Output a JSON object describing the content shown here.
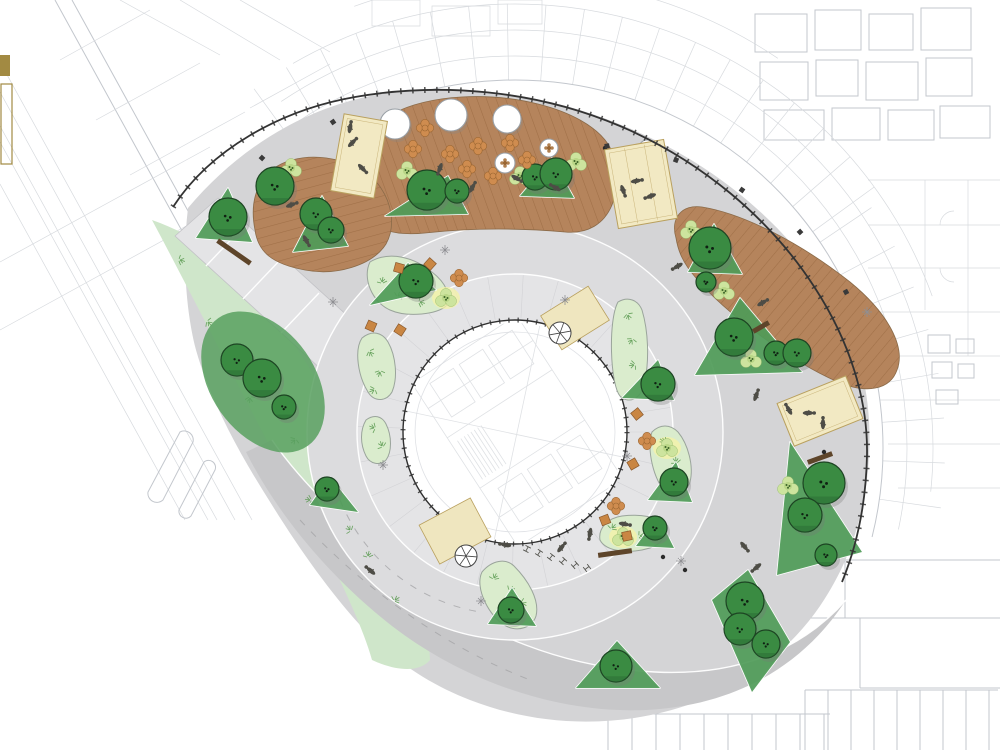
{
  "title": "Circular plaza landscape site plan around tower footprint",
  "colors": {
    "cad_light": "#d7dade",
    "cad_mid": "#c3c7cd",
    "plaza": "#d4d4d6",
    "plaza_dark": "#c7c7c9",
    "road": "#dcdcde",
    "inner_ring": "#e4e4e6",
    "walkway": "#e4e4e6",
    "curb": "#ffffff",
    "lawn": "#cfe6ca",
    "bed": "#daeccd",
    "bed_line": "#9aa49b",
    "under_green": "#4f9b58",
    "blob_green": "#58a05f",
    "tree": "#3a8b42",
    "tree_dark": "#2a6b33",
    "tree_line": "#1d4423",
    "shrub": "#cde49e",
    "shrub_mid": "#b9d687",
    "shrub_dot": "#3c6428",
    "deck": "#b5845c",
    "plank": "#9f6f47",
    "platform": "#f2e9c3",
    "platform_line": "#b9a05e",
    "mat": "#efe6bf",
    "gold": "#a28a42",
    "flower": "#cf8c4f",
    "flower_line": "#9a6632",
    "bench": "#5e452a",
    "people": "#4e4d46",
    "arc": "#333333",
    "glow": "#f6f3a6",
    "canopy_line": "#9aa0a6",
    "metal": "#8f8f93"
  },
  "legend": {
    "swatch_color": "#a28a42"
  },
  "plan": {
    "trees": [
      [
        228,
        217,
        19
      ],
      [
        275,
        186,
        19
      ],
      [
        316,
        214,
        16
      ],
      [
        331,
        230,
        13
      ],
      [
        427,
        190,
        20
      ],
      [
        457,
        191,
        12
      ],
      [
        535,
        177,
        13
      ],
      [
        556,
        174,
        16
      ],
      [
        710,
        248,
        21
      ],
      [
        706,
        282,
        10
      ],
      [
        734,
        337,
        19
      ],
      [
        776,
        353,
        12
      ],
      [
        797,
        353,
        14
      ],
      [
        416,
        281,
        17
      ],
      [
        658,
        384,
        17
      ],
      [
        674,
        482,
        14
      ],
      [
        655,
        528,
        12
      ],
      [
        237,
        360,
        16
      ],
      [
        262,
        378,
        19
      ],
      [
        284,
        407,
        12
      ],
      [
        327,
        489,
        12
      ],
      [
        511,
        610,
        13
      ],
      [
        616,
        666,
        16
      ],
      [
        824,
        483,
        21
      ],
      [
        805,
        515,
        17
      ],
      [
        826,
        555,
        11
      ],
      [
        745,
        601,
        19
      ],
      [
        740,
        629,
        16
      ],
      [
        766,
        644,
        14
      ]
    ],
    "saplings": [
      [
        621,
        193
      ]
    ],
    "shrubs": [
      [
        291,
        168
      ],
      [
        407,
        171
      ],
      [
        520,
        176
      ],
      [
        576,
        162
      ],
      [
        724,
        291
      ],
      [
        751,
        359
      ],
      [
        788,
        486
      ],
      [
        446,
        298
      ],
      [
        623,
        537
      ],
      [
        667,
        448
      ],
      [
        691,
        230
      ]
    ],
    "glows": [
      [
        446,
        298
      ],
      [
        623,
        537
      ],
      [
        667,
        448
      ]
    ],
    "sprigs": [
      [
        382,
        282
      ],
      [
        398,
        296
      ],
      [
        420,
        302
      ],
      [
        370,
        352
      ],
      [
        380,
        372
      ],
      [
        374,
        390
      ],
      [
        374,
        428
      ],
      [
        382,
        446
      ],
      [
        494,
        578
      ],
      [
        510,
        590
      ],
      [
        522,
        603
      ],
      [
        628,
        315
      ],
      [
        632,
        340
      ],
      [
        634,
        365
      ],
      [
        664,
        442
      ],
      [
        676,
        462
      ],
      [
        612,
        528
      ],
      [
        640,
        536
      ],
      [
        208,
        322
      ],
      [
        250,
        398
      ],
      [
        295,
        440
      ],
      [
        310,
        500
      ],
      [
        350,
        530
      ],
      [
        368,
        556
      ],
      [
        395,
        600
      ],
      [
        180,
        260
      ]
    ],
    "flowers": [
      [
        425,
        128
      ],
      [
        413,
        149
      ],
      [
        450,
        154
      ],
      [
        478,
        146
      ],
      [
        510,
        143
      ],
      [
        467,
        169
      ],
      [
        527,
        160
      ],
      [
        493,
        176
      ],
      [
        459,
        278
      ],
      [
        647,
        441
      ],
      [
        616,
        506
      ]
    ],
    "cubes": [
      [
        399,
        268
      ],
      [
        371,
        326
      ],
      [
        400,
        330
      ],
      [
        430,
        264
      ],
      [
        637,
        414
      ],
      [
        633,
        464
      ],
      [
        605,
        520
      ],
      [
        627,
        536
      ]
    ],
    "canopies": [
      [
        395,
        124,
        15
      ],
      [
        451,
        115,
        16
      ],
      [
        507,
        119,
        14
      ]
    ],
    "umbrellas": [
      [
        505,
        163,
        10
      ],
      [
        549,
        148,
        9
      ],
      [
        647,
        148,
        8
      ]
    ],
    "benches": [
      [
        234,
        252,
        40,
        35
      ],
      [
        615,
        553,
        34,
        -8
      ],
      [
        820,
        458,
        26,
        -20
      ],
      [
        761,
        327,
        18,
        -30
      ]
    ],
    "bikes": [
      [
        527,
        549
      ],
      [
        539,
        553
      ],
      [
        551,
        557
      ],
      [
        563,
        561
      ],
      [
        575,
        565
      ],
      [
        587,
        568
      ]
    ],
    "people": [
      [
        350,
        128,
        10
      ],
      [
        440,
        168,
        200
      ],
      [
        472,
        188,
        30
      ],
      [
        516,
        178,
        120
      ],
      [
        556,
        188,
        300
      ],
      [
        636,
        181,
        80
      ],
      [
        306,
        240,
        150
      ],
      [
        678,
        266,
        240
      ],
      [
        762,
        303,
        60
      ],
      [
        789,
        410,
        330
      ],
      [
        756,
        396,
        20
      ],
      [
        624,
        524,
        100
      ],
      [
        590,
        533,
        190
      ],
      [
        506,
        545,
        280
      ],
      [
        561,
        548,
        40
      ],
      [
        744,
        546,
        140
      ],
      [
        757,
        567,
        230
      ],
      [
        371,
        571,
        310
      ],
      [
        291,
        205,
        70
      ],
      [
        623,
        190,
        160
      ],
      [
        651,
        196,
        250
      ],
      [
        808,
        413,
        90
      ],
      [
        823,
        424,
        0
      ],
      [
        352,
        143,
        45
      ],
      [
        362,
        168,
        135
      ]
    ],
    "crosses": [
      [
        333,
        302
      ],
      [
        383,
        465
      ],
      [
        627,
        456
      ],
      [
        681,
        561
      ],
      [
        565,
        300
      ],
      [
        867,
        312
      ],
      [
        481,
        601
      ],
      [
        445,
        250
      ]
    ],
    "arc_squares": [
      [
        607,
        146,
        -8
      ],
      [
        676,
        160,
        22
      ],
      [
        742,
        190,
        35
      ],
      [
        800,
        232,
        48
      ],
      [
        846,
        292,
        62
      ],
      [
        333,
        122,
        -35
      ],
      [
        262,
        158,
        -48
      ]
    ],
    "dots": [
      [
        663,
        557
      ],
      [
        685,
        570
      ],
      [
        824,
        452
      ],
      [
        605,
        148
      ]
    ],
    "joint_spokes": [
      {
        "cx": 515,
        "cy": 432,
        "r1": 114,
        "r2": 157,
        "a1": 0,
        "a2": 360,
        "step": 13,
        "cls": "joint"
      }
    ],
    "cad_spokes": [
      {
        "cx": 515,
        "cy": 448,
        "r1": 368,
        "r2": 444,
        "a1": -126,
        "a2": -36,
        "step": 5,
        "cls": "cadL"
      },
      {
        "cx": 515,
        "cy": 448,
        "r1": 368,
        "r2": 430,
        "a1": -34,
        "a2": 12,
        "step": 6,
        "cls": "cadL"
      }
    ],
    "cad_arcs": [
      {
        "cx": 515,
        "cy": 448,
        "r": 368,
        "a1": -128,
        "a2": 14,
        "cls": "cadM"
      },
      {
        "cx": 515,
        "cy": 448,
        "r": 392,
        "a1": -126,
        "a2": 12,
        "cls": "cadL"
      },
      {
        "cx": 515,
        "cy": 448,
        "r": 418,
        "a1": -124,
        "a2": 6,
        "cls": "cadL"
      },
      {
        "cx": 515,
        "cy": 448,
        "r": 444,
        "a1": -120,
        "a2": -20,
        "cls": "cadL"
      },
      {
        "cx": 515,
        "cy": 448,
        "r": 470,
        "a1": -110,
        "a2": -56,
        "cls": "cadL"
      }
    ],
    "grids": [
      {
        "x1": 608,
        "x2": 830,
        "y1": 714,
        "y2": 750,
        "step": 24,
        "cls": "cadM"
      },
      {
        "x1": 805,
        "x2": 998,
        "y1": 690,
        "y2": 750,
        "step": 23,
        "cls": "cadM"
      }
    ]
  }
}
